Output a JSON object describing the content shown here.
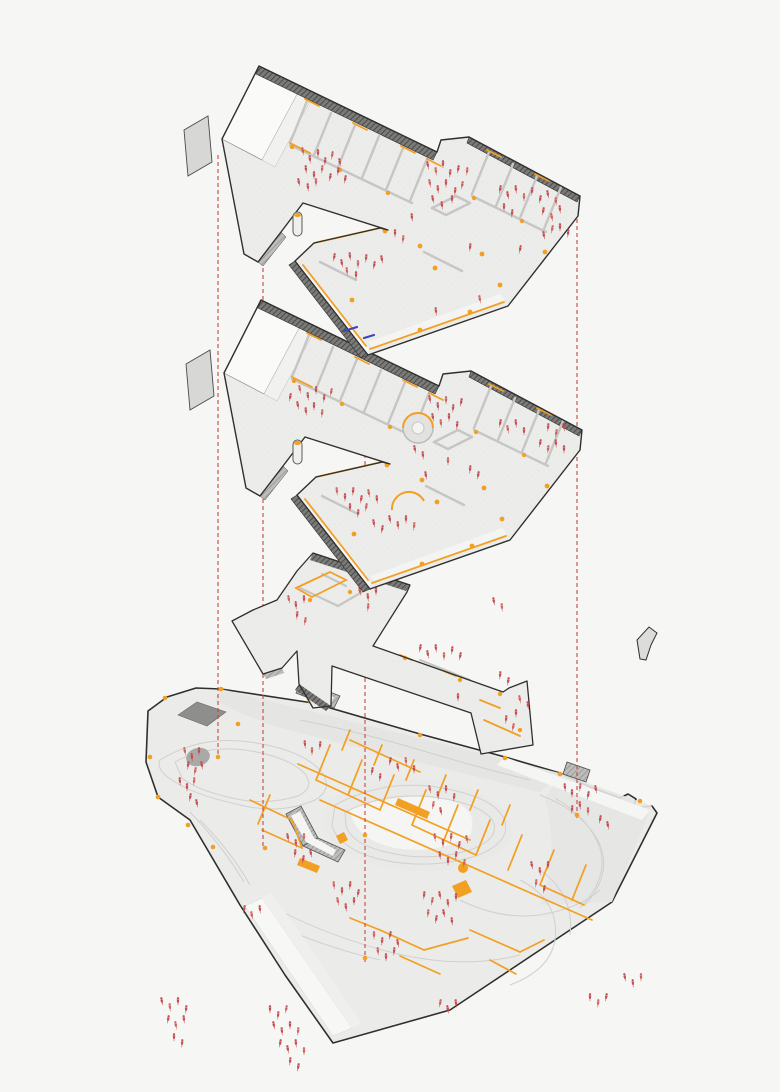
{
  "diagram": {
    "title": "Exploded axonometric diagram",
    "subtitle": "Three stacked floor plates over a topographic site plan",
    "type": "architectural-exploded-axonometric",
    "levels": [
      {
        "id": "top-floor",
        "label": "Upper floor plate",
        "position": "top"
      },
      {
        "id": "middle-floor",
        "label": "Middle floor plate",
        "position": "middle"
      },
      {
        "id": "entry-level",
        "label": "Entry / connector level",
        "position": "lower"
      },
      {
        "id": "site-plan",
        "label": "Ground site plan with contours",
        "position": "bottom"
      }
    ]
  },
  "colors": {
    "background": "#f6f6f4",
    "outline_dark": "#2f2f2d",
    "floor_gray": "#ececea",
    "wall_gray": "#c9c9c7",
    "parapet_dark": "#6f6f6d",
    "accent_orange": "#f2a024",
    "figure_red": "#bf4a4f",
    "figure_red_alt": "#c95f5a",
    "guide_line_red": "#c8463a",
    "blue_accent": "#3a47b5",
    "site_ground": "#ebebe9",
    "contour_gray": "#d0d0ce",
    "site_dark_roof": "#8e8e8c"
  },
  "guide_lines": [
    {
      "x": 218,
      "y1": 155,
      "y2": 758
    },
    {
      "x": 263,
      "y1": 268,
      "y2": 848
    },
    {
      "x": 365,
      "y1": 356,
      "y2": 962
    },
    {
      "x": 577,
      "y1": 198,
      "y2": 818
    }
  ],
  "capsules": [
    {
      "x": 293,
      "y": 212,
      "w": 9,
      "h": 24
    },
    {
      "x": 293,
      "y": 440,
      "w": 9,
      "h": 24
    }
  ],
  "blue_marks": [
    [
      344,
      331,
      357,
      327
    ],
    [
      364,
      338,
      374,
      335
    ]
  ],
  "orange_nodes": [
    [
      165,
      698
    ],
    [
      150,
      757
    ],
    [
      158,
      797
    ],
    [
      188,
      825
    ],
    [
      213,
      847
    ],
    [
      221,
      689
    ],
    [
      238,
      724
    ],
    [
      310,
      701
    ],
    [
      365,
      835
    ],
    [
      265,
      848
    ],
    [
      218,
      757
    ],
    [
      577,
      815
    ],
    [
      640,
      801
    ],
    [
      365,
      958
    ],
    [
      420,
      735
    ],
    [
      505,
      758
    ],
    [
      560,
      774
    ]
  ],
  "figures": {
    "top_floor": [
      [
        303,
        152
      ],
      [
        310,
        160
      ],
      [
        318,
        154
      ],
      [
        325,
        162
      ],
      [
        332,
        156
      ],
      [
        340,
        163
      ],
      [
        306,
        170
      ],
      [
        314,
        176
      ],
      [
        322,
        170
      ],
      [
        330,
        178
      ],
      [
        299,
        183
      ],
      [
        308,
        188
      ],
      [
        316,
        183
      ],
      [
        338,
        172
      ],
      [
        345,
        180
      ],
      [
        428,
        166
      ],
      [
        436,
        172
      ],
      [
        443,
        165
      ],
      [
        450,
        174
      ],
      [
        458,
        170
      ],
      [
        430,
        184
      ],
      [
        438,
        190
      ],
      [
        446,
        184
      ],
      [
        455,
        192
      ],
      [
        462,
        186
      ],
      [
        433,
        200
      ],
      [
        442,
        206
      ],
      [
        452,
        200
      ],
      [
        467,
        172
      ],
      [
        500,
        190
      ],
      [
        508,
        196
      ],
      [
        516,
        190
      ],
      [
        524,
        198
      ],
      [
        532,
        192
      ],
      [
        540,
        200
      ],
      [
        548,
        195
      ],
      [
        556,
        202
      ],
      [
        504,
        208
      ],
      [
        512,
        214
      ],
      [
        543,
        212
      ],
      [
        552,
        218
      ],
      [
        560,
        210
      ],
      [
        560,
        228
      ],
      [
        568,
        234
      ],
      [
        552,
        230
      ],
      [
        544,
        236
      ],
      [
        412,
        218
      ],
      [
        395,
        234
      ],
      [
        403,
        240
      ],
      [
        334,
        258
      ],
      [
        342,
        264
      ],
      [
        350,
        257
      ],
      [
        358,
        265
      ],
      [
        366,
        259
      ],
      [
        374,
        266
      ],
      [
        382,
        260
      ],
      [
        347,
        272
      ],
      [
        356,
        276
      ],
      [
        470,
        248
      ],
      [
        520,
        250
      ],
      [
        480,
        300
      ],
      [
        436,
        312
      ]
    ],
    "middle_floor": [
      [
        300,
        390
      ],
      [
        308,
        397
      ],
      [
        316,
        391
      ],
      [
        324,
        399
      ],
      [
        331,
        393
      ],
      [
        298,
        406
      ],
      [
        306,
        412
      ],
      [
        314,
        407
      ],
      [
        322,
        414
      ],
      [
        290,
        398
      ],
      [
        430,
        400
      ],
      [
        438,
        407
      ],
      [
        446,
        401
      ],
      [
        453,
        409
      ],
      [
        461,
        403
      ],
      [
        433,
        418
      ],
      [
        441,
        424
      ],
      [
        449,
        418
      ],
      [
        457,
        426
      ],
      [
        500,
        424
      ],
      [
        508,
        430
      ],
      [
        516,
        424
      ],
      [
        524,
        432
      ],
      [
        548,
        428
      ],
      [
        556,
        434
      ],
      [
        564,
        428
      ],
      [
        556,
        444
      ],
      [
        564,
        450
      ],
      [
        548,
        450
      ],
      [
        540,
        444
      ],
      [
        415,
        450
      ],
      [
        423,
        456
      ],
      [
        448,
        462
      ],
      [
        470,
        470
      ],
      [
        478,
        476
      ],
      [
        426,
        476
      ],
      [
        337,
        492
      ],
      [
        345,
        498
      ],
      [
        353,
        492
      ],
      [
        361,
        500
      ],
      [
        369,
        494
      ],
      [
        377,
        500
      ],
      [
        350,
        508
      ],
      [
        358,
        514
      ],
      [
        366,
        508
      ],
      [
        390,
        520
      ],
      [
        398,
        526
      ],
      [
        406,
        520
      ],
      [
        414,
        527
      ],
      [
        382,
        530
      ],
      [
        374,
        524
      ]
    ],
    "entry_level": [
      [
        289,
        600
      ],
      [
        296,
        606
      ],
      [
        304,
        600
      ],
      [
        297,
        616
      ],
      [
        305,
        622
      ],
      [
        360,
        592
      ],
      [
        368,
        598
      ],
      [
        376,
        592
      ],
      [
        368,
        608
      ],
      [
        420,
        649
      ],
      [
        428,
        655
      ],
      [
        436,
        649
      ],
      [
        444,
        657
      ],
      [
        452,
        651
      ],
      [
        460,
        657
      ],
      [
        494,
        602
      ],
      [
        502,
        608
      ],
      [
        458,
        698
      ],
      [
        500,
        676
      ],
      [
        508,
        682
      ],
      [
        520,
        700
      ],
      [
        528,
        706
      ],
      [
        516,
        714
      ],
      [
        506,
        720
      ],
      [
        513,
        728
      ]
    ],
    "site": [
      [
        185,
        752
      ],
      [
        192,
        758
      ],
      [
        199,
        752
      ],
      [
        188,
        766
      ],
      [
        195,
        772
      ],
      [
        202,
        766
      ],
      [
        180,
        782
      ],
      [
        187,
        788
      ],
      [
        194,
        782
      ],
      [
        190,
        798
      ],
      [
        197,
        804
      ],
      [
        305,
        745
      ],
      [
        312,
        752
      ],
      [
        320,
        746
      ],
      [
        390,
        762
      ],
      [
        398,
        768
      ],
      [
        406,
        762
      ],
      [
        414,
        770
      ],
      [
        380,
        778
      ],
      [
        372,
        772
      ],
      [
        430,
        790
      ],
      [
        438,
        796
      ],
      [
        446,
        790
      ],
      [
        454,
        798
      ],
      [
        433,
        806
      ],
      [
        441,
        812
      ],
      [
        565,
        788
      ],
      [
        572,
        794
      ],
      [
        580,
        788
      ],
      [
        588,
        796
      ],
      [
        596,
        790
      ],
      [
        580,
        806
      ],
      [
        588,
        812
      ],
      [
        572,
        810
      ],
      [
        600,
        820
      ],
      [
        608,
        826
      ],
      [
        435,
        838
      ],
      [
        443,
        844
      ],
      [
        451,
        838
      ],
      [
        459,
        846
      ],
      [
        467,
        840
      ],
      [
        440,
        856
      ],
      [
        448,
        862
      ],
      [
        456,
        856
      ],
      [
        464,
        864
      ],
      [
        532,
        866
      ],
      [
        540,
        872
      ],
      [
        548,
        866
      ],
      [
        536,
        884
      ],
      [
        544,
        890
      ],
      [
        288,
        838
      ],
      [
        296,
        844
      ],
      [
        304,
        838
      ],
      [
        295,
        854
      ],
      [
        303,
        860
      ],
      [
        311,
        854
      ],
      [
        334,
        886
      ],
      [
        342,
        892
      ],
      [
        350,
        886
      ],
      [
        358,
        894
      ],
      [
        338,
        902
      ],
      [
        346,
        908
      ],
      [
        354,
        902
      ],
      [
        424,
        896
      ],
      [
        432,
        902
      ],
      [
        440,
        896
      ],
      [
        448,
        904
      ],
      [
        456,
        898
      ],
      [
        428,
        914
      ],
      [
        436,
        920
      ],
      [
        444,
        914
      ],
      [
        452,
        922
      ],
      [
        374,
        936
      ],
      [
        382,
        942
      ],
      [
        390,
        936
      ],
      [
        398,
        944
      ],
      [
        378,
        952
      ],
      [
        386,
        958
      ],
      [
        394,
        952
      ],
      [
        244,
        910
      ],
      [
        252,
        916
      ],
      [
        260,
        910
      ],
      [
        270,
        1010
      ],
      [
        278,
        1016
      ],
      [
        286,
        1010
      ],
      [
        274,
        1026
      ],
      [
        282,
        1032
      ],
      [
        290,
        1026
      ],
      [
        298,
        1032
      ],
      [
        280,
        1044
      ],
      [
        288,
        1050
      ],
      [
        296,
        1044
      ],
      [
        304,
        1052
      ],
      [
        290,
        1062
      ],
      [
        298,
        1068
      ],
      [
        162,
        1002
      ],
      [
        170,
        1008
      ],
      [
        178,
        1002
      ],
      [
        186,
        1010
      ],
      [
        168,
        1020
      ],
      [
        176,
        1026
      ],
      [
        184,
        1020
      ],
      [
        174,
        1038
      ],
      [
        182,
        1044
      ],
      [
        440,
        1004
      ],
      [
        448,
        1010
      ],
      [
        456,
        1004
      ],
      [
        590,
        998
      ],
      [
        598,
        1004
      ],
      [
        606,
        998
      ],
      [
        625,
        978
      ],
      [
        633,
        984
      ],
      [
        641,
        978
      ]
    ]
  }
}
